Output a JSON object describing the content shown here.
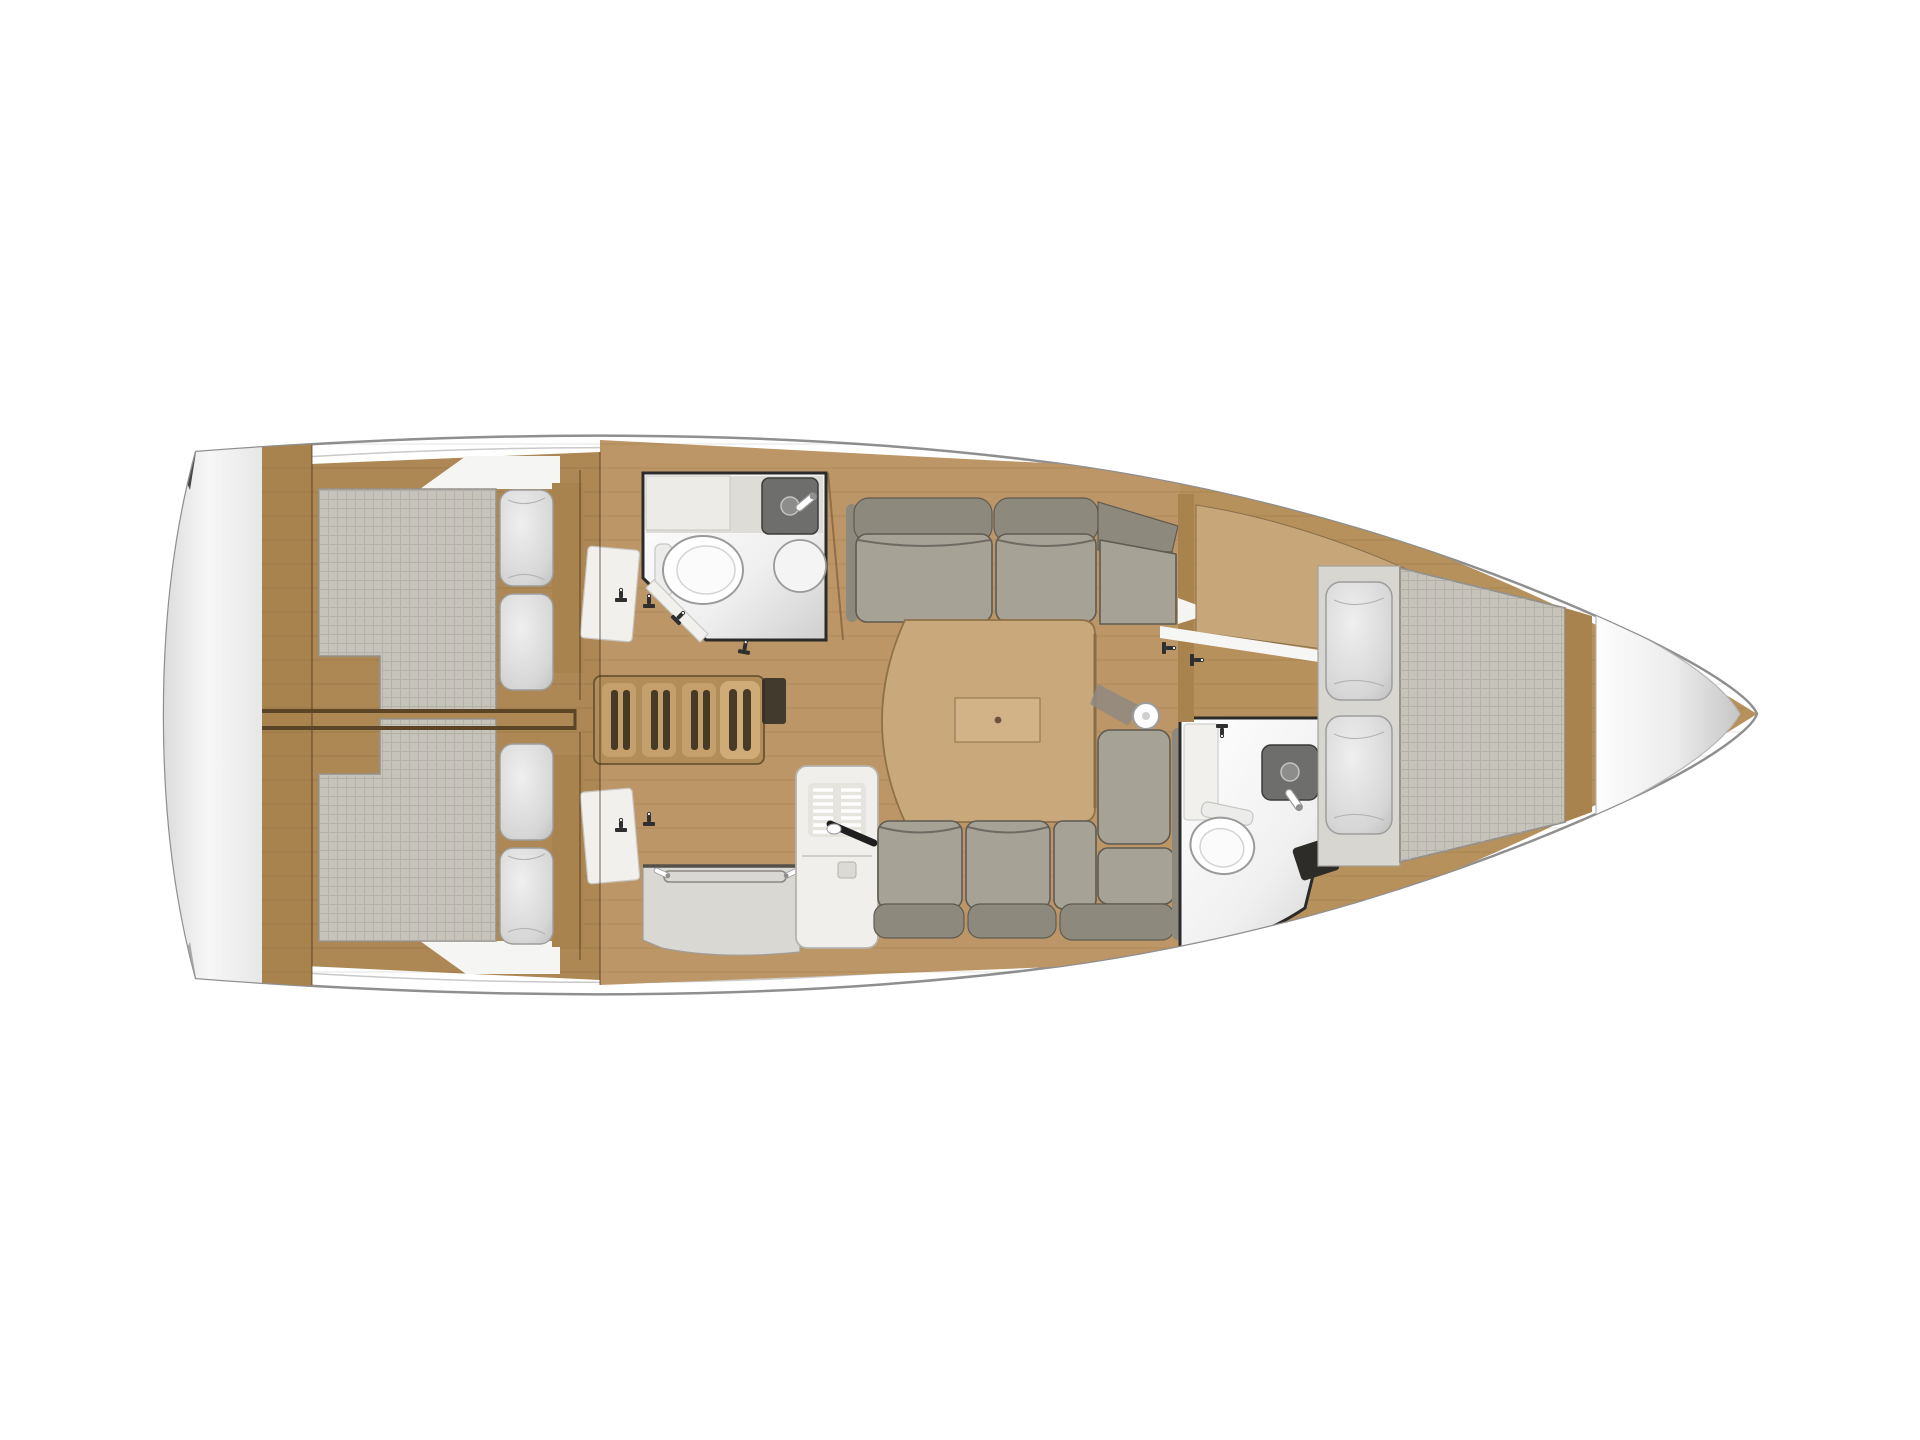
{
  "meta": {
    "title": "Sailing yacht interior layout plan — top view",
    "view": "overhead floor plan"
  },
  "colors": {
    "background": "#ffffff",
    "hull_white": "#ffffff",
    "hull_line": "#8f8f8f",
    "hull_line_light": "#c9c9c9",
    "deck_wood_aft": "#ad8754",
    "deck_wood_salon": "#bc9666",
    "deck_wood_fwd": "#b6915c",
    "trim_wood": "#a8834e",
    "panel_wood": "#c7a77a",
    "table_wood": "#c9a97b",
    "table_leaf": "#d2b388",
    "table_edge": "#8f7147",
    "stair_wood": "#c3a06c",
    "stair_base": "#b28d5a",
    "stair_slot": "#473a27",
    "cushion": "#a7a296",
    "backrest": "#8e897d",
    "cushion_edge": "#5f5b53",
    "mattress": "#c6c3bb",
    "mattress_line": "#93908a",
    "bed_platform": "#d8d6d0",
    "pillow_line": "#9d9d9d",
    "wall_dark": "#2b2b2b",
    "counter": "#dad8d2",
    "counter_edge": "#55504a",
    "appliance": "#f0efeb",
    "appliance_panel": "#e6e4de",
    "appliance_line": "#b5b3ad",
    "sink_dark": "#6e6e6c",
    "fixture_white": "#ffffff",
    "fixture_line": "#9a9a9a",
    "hardware": "#2f2f2f",
    "step_dark": "#4f4a43",
    "locker_white": "#ecebe7",
    "door_white": "#f2f0ec",
    "shadow_wedge": "#2a2a2a",
    "divider_dark": "#5c4526"
  }
}
